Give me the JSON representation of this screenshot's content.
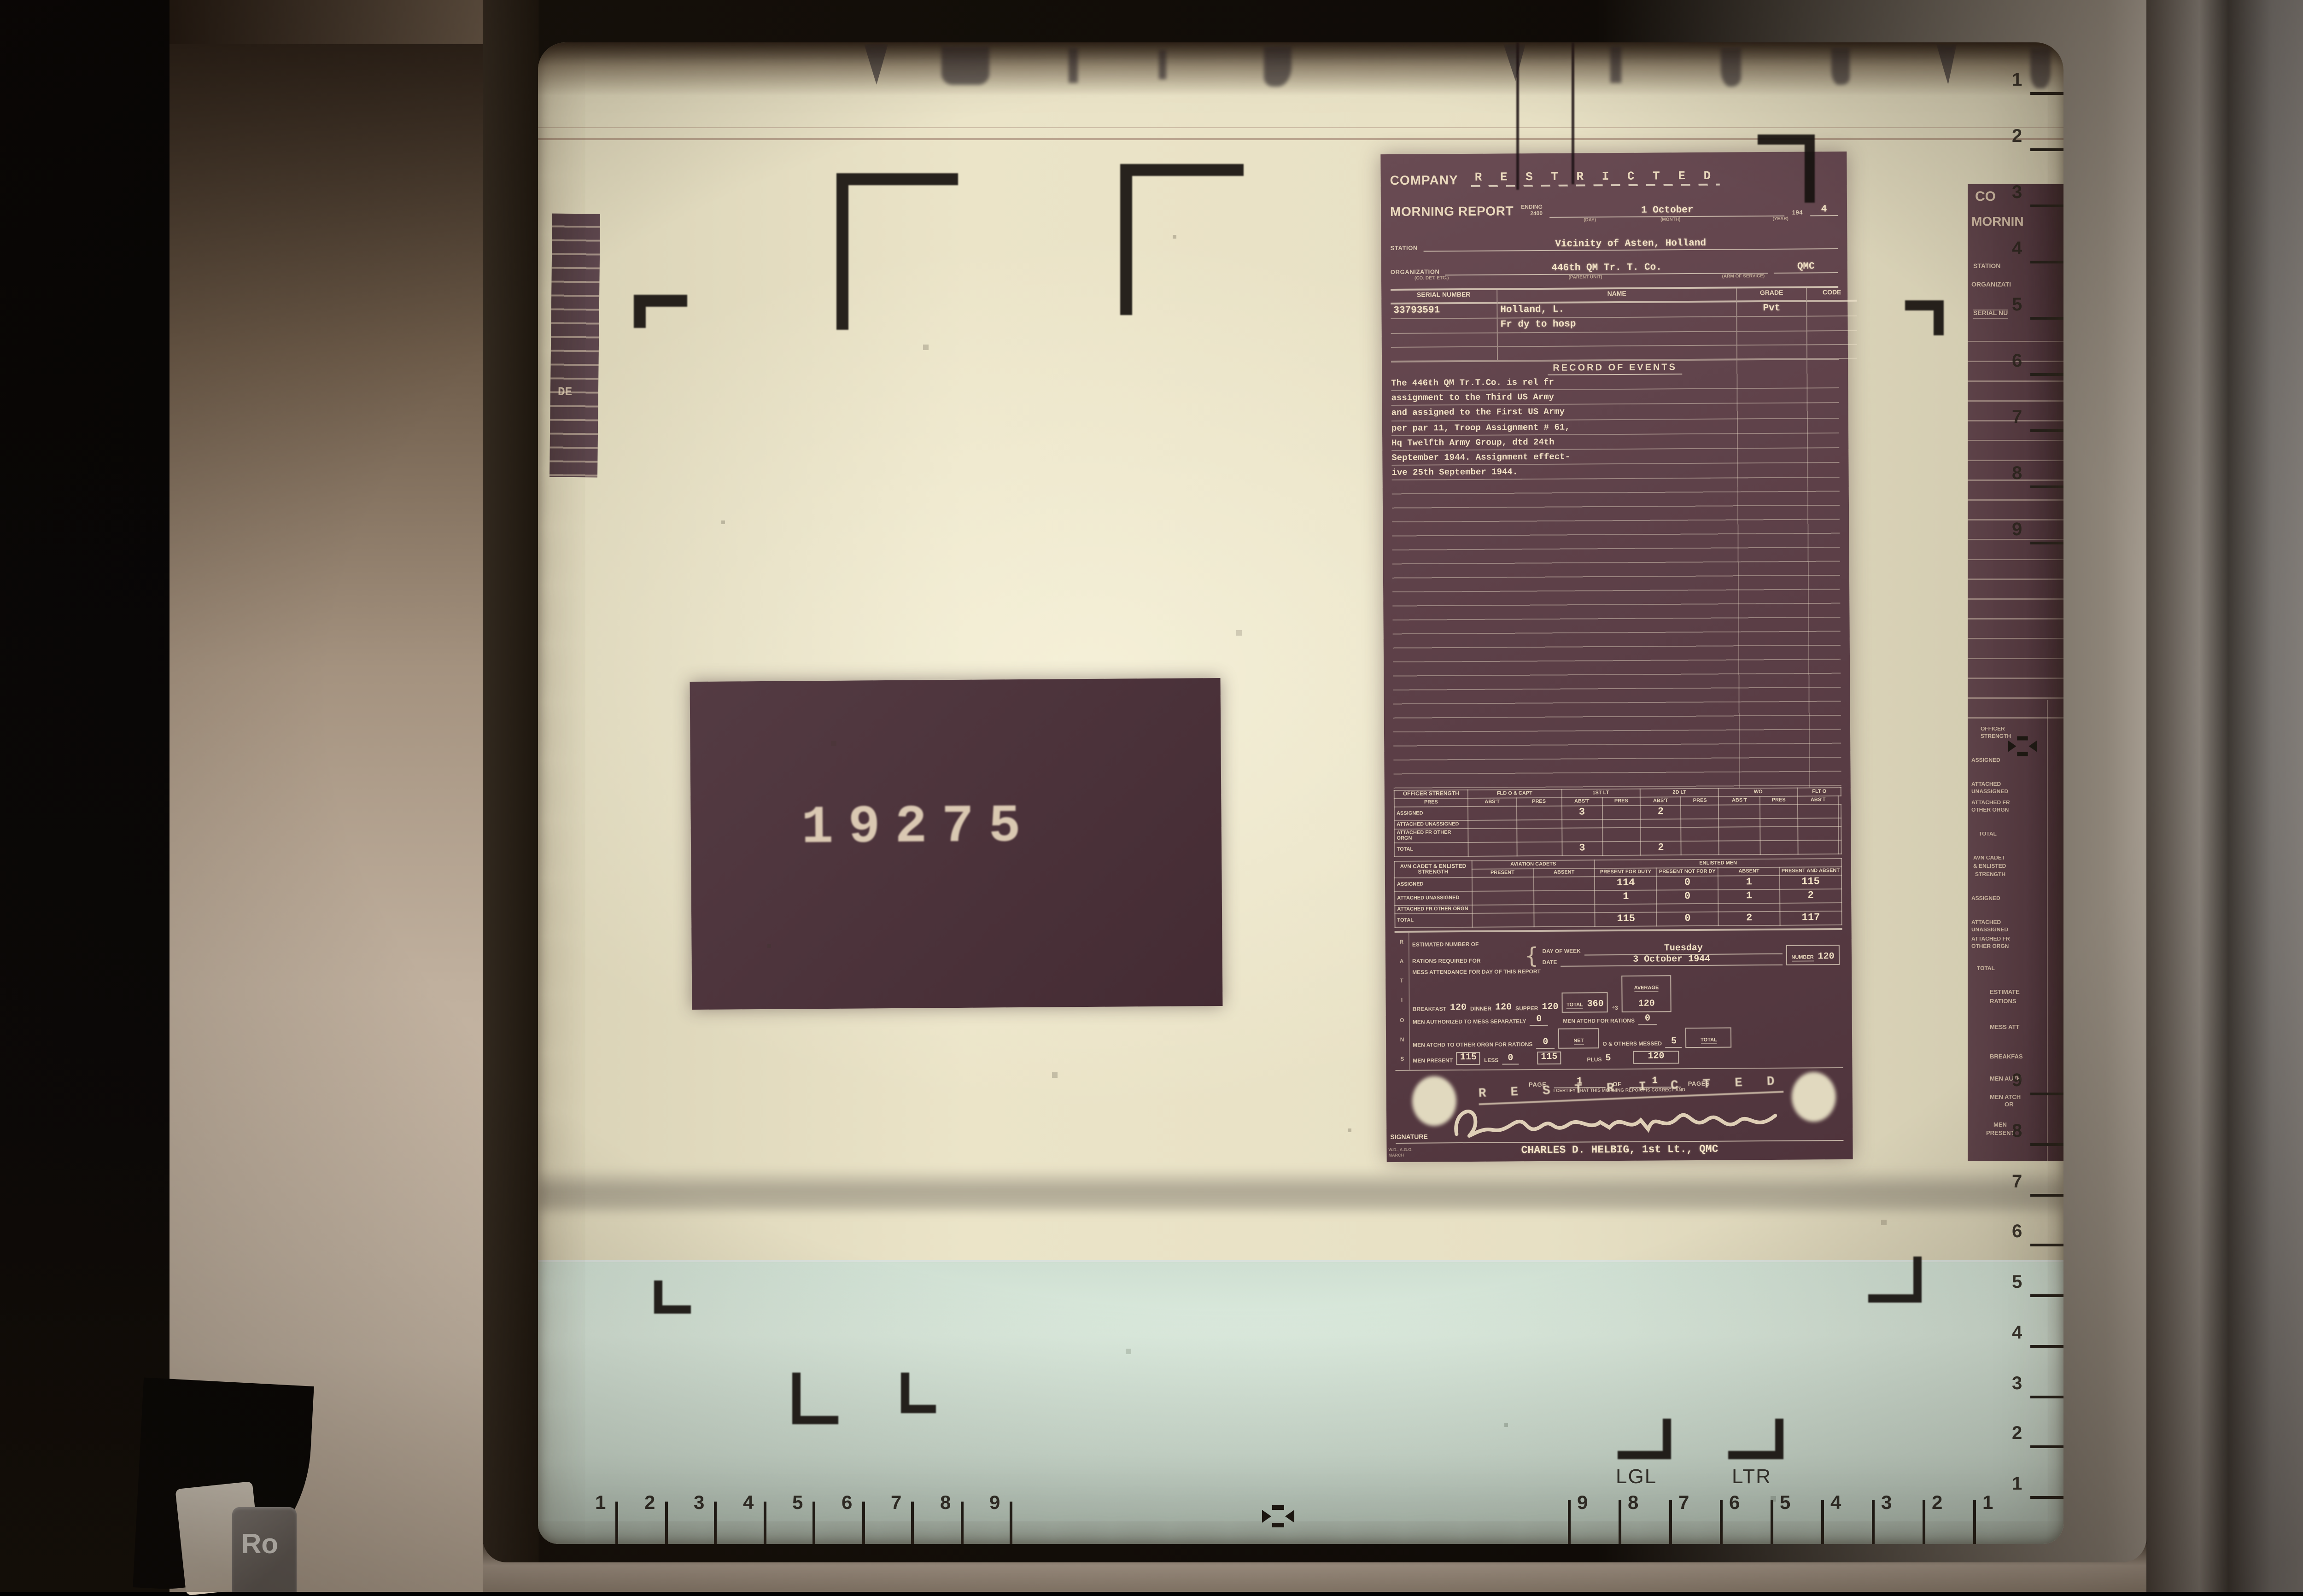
{
  "machine": {
    "key_label": "Ro"
  },
  "screen": {
    "plate_number": "19275",
    "left_strip_fragment": "DE",
    "rulers": {
      "bottom_left": [
        "1",
        "2",
        "3",
        "4",
        "5",
        "6",
        "7",
        "8",
        "9"
      ],
      "bottom_right": [
        "9",
        "8",
        "7",
        "6",
        "5",
        "4",
        "3",
        "2",
        "1"
      ],
      "right_top": [
        "1",
        "2",
        "3",
        "4",
        "5",
        "6",
        "7",
        "8",
        "9"
      ],
      "right_bottom": [
        "9",
        "8",
        "7",
        "6",
        "5",
        "4",
        "3",
        "2",
        "1"
      ],
      "size_legal": "LGL",
      "size_letter": "LTR"
    }
  },
  "document": {
    "title_company": "COMPANY",
    "title_morning": "MORNING REPORT",
    "classification": "R E S T R I C T E D",
    "ending_label": "ENDING",
    "ending_value": "2400",
    "date_value": "1 October",
    "year_prefix": "194",
    "year_value": "4",
    "sub_day": "(DAY)",
    "sub_month": "(MONTH)",
    "sub_year": "(YEAR)",
    "station_label": "STATION",
    "station_value": "Vicinity of Asten, Holland",
    "organization_label": "ORGANIZATION",
    "organization_value": "446th QM Tr. T. Co.",
    "arm_value": "QMC",
    "sub_co": "(CO. DET. ETC.)",
    "sub_parent": "(PARENT UNIT)",
    "sub_arm": "(ARM OF SERVICE)",
    "roster": {
      "headers": [
        "SERIAL NUMBER",
        "NAME",
        "GRADE",
        "CODE"
      ],
      "rows": [
        {
          "serial": "33793591",
          "name": "Holland, L.",
          "grade": "Pvt",
          "code": ""
        },
        {
          "serial": "",
          "name": "Fr dy to hosp",
          "grade": "",
          "code": ""
        }
      ]
    },
    "record_of_events": {
      "title": "RECORD OF EVENTS",
      "lines": [
        "The 446th QM Tr.T.Co. is rel fr",
        "assignment to the Third US Army",
        "and assigned to the First US Army",
        "per par 11, Troop Assignment # 61,",
        "Hq Twelfth Army Group, dtd 24th",
        "September 1944.  Assignment effect-",
        "ive 25th September 1944."
      ]
    },
    "officer_table": {
      "title": "OFFICER STRENGTH",
      "groups": [
        "FLD O & CAPT",
        "1ST LT",
        "2D LT",
        "WO",
        "FLT O"
      ],
      "sub_row": [
        "PRES",
        "ABS'T",
        "PRES",
        "ABS'T",
        "PRES",
        "ABS'T",
        "PRES",
        "ABS'T",
        "PRES",
        "ABS'T"
      ],
      "rows": [
        {
          "label": "ASSIGNED",
          "cells": [
            "",
            "",
            "3",
            "",
            "2",
            "",
            "",
            "",
            "",
            ""
          ]
        },
        {
          "label": "ATTACHED UNASSIGNED",
          "cells": [
            "",
            "",
            "",
            "",
            "",
            "",
            "",
            "",
            "",
            ""
          ]
        },
        {
          "label": "ATTACHED FR OTHER ORGN",
          "cells": [
            "",
            "",
            "",
            "",
            "",
            "",
            "",
            "",
            "",
            ""
          ]
        },
        {
          "label": "TOTAL",
          "cells": [
            "",
            "",
            "3",
            "",
            "2",
            "",
            "",
            "",
            "",
            ""
          ]
        }
      ]
    },
    "enlisted_table": {
      "title": "AVN CADET & ENLISTED STRENGTH",
      "group1": "AVIATION CADETS",
      "group2": "ENLISTED MEN",
      "sub_row": [
        "PRESENT",
        "ABSENT",
        "PRESENT FOR DUTY",
        "PRESENT NOT FOR DY",
        "ABSENT",
        "PRESENT AND ABSENT"
      ],
      "rows": [
        {
          "label": "ASSIGNED",
          "cells": [
            "",
            "",
            "114",
            "0",
            "1",
            "115"
          ]
        },
        {
          "label": "ATTACHED UNASSIGNED",
          "cells": [
            "",
            "",
            "1",
            "0",
            "1",
            "2"
          ]
        },
        {
          "label": "ATTACHED FR OTHER ORGN",
          "cells": [
            "",
            "",
            "",
            "",
            "",
            ""
          ]
        },
        {
          "label": "TOTAL",
          "cells": [
            "",
            "",
            "115",
            "0",
            "2",
            "117"
          ]
        }
      ]
    },
    "rations": {
      "rail_letters": [
        "R",
        "A",
        "T",
        "I",
        "O",
        "N",
        "S"
      ],
      "est_label1": "ESTIMATED NUMBER OF",
      "est_label2": "RATIONS REQUIRED FOR",
      "day_of_week_label": "DAY OF WEEK",
      "day_of_week": "Tuesday",
      "date_label": "DATE",
      "date": "3 October 1944",
      "number_label": "NUMBER",
      "number": "120",
      "mess_label": "MESS ATTENDANCE FOR DAY OF THIS REPORT",
      "breakfast_label": "BREAKFAST",
      "breakfast": "120",
      "dinner_label": "DINNER",
      "dinner": "120",
      "supper_label": "SUPPER",
      "supper": "120",
      "total_label": "TOTAL",
      "total": "360",
      "divisor": "÷3",
      "average_label": "AVERAGE",
      "average": "120",
      "mess_sep_label": "MEN AUTHORIZED TO MESS SEPARATELY",
      "mess_sep": "0",
      "atchd_rations_label": "MEN ATCHD FOR RATIONS",
      "atchd_rations": "0",
      "atchd_other_label": "MEN ATCHD TO OTHER ORGN FOR RATIONS",
      "atchd_other": "0",
      "net_label": "NET",
      "others_messed_label": "O & OTHERS MESSED",
      "others_messed": "5",
      "men_present_label": "MEN PRESENT",
      "men_present": "115",
      "less_label": "LESS",
      "less": "0",
      "net": "115",
      "plus_label": "PLUS",
      "plus": "5",
      "grand_total_label": "TOTAL",
      "grand_total": "120"
    },
    "footer": {
      "page_label": "PAGE",
      "page": "1",
      "of_label": "OF",
      "pages": "1",
      "pages_label": "PAGES",
      "certify_line": "I CERTIFY THAT THIS MORNING REPORT IS CORRECT AND",
      "stamp": "R E S T R I C T E D",
      "signature_label": "SIGNATURE",
      "signature_name": "CHARLES D. HELBIG, 1st Lt., QMC",
      "form_note1": "W.D., A.G.O.",
      "form_note2": "MARCH"
    }
  },
  "right_doc": {
    "line1": "CO",
    "line2": "MORNIN",
    "station": "STATION",
    "organization": "ORGANIZATI",
    "serial": "SERIAL NU",
    "officer1": "OFFICER",
    "officer2": "STRENGTH",
    "assigned1": "ASSIGNED",
    "att1a": "ATTACHED",
    "att1b": "UNASSIGNED",
    "att1c": "ATTACHED FR",
    "att1d": "OTHER ORGN",
    "total1": "TOTAL",
    "avn1": "AVN CADET",
    "avn2": "& ENLISTED",
    "avn3": "STRENGTH",
    "assigned2": "ASSIGNED",
    "att2a": "ATTACHED",
    "att2b": "UNASSIGNED",
    "att2c": "ATTACHED FR",
    "att2d": "OTHER ORGN",
    "total2": "TOTAL",
    "r1": "ESTIMATE",
    "r2": "RATIONS",
    "r3": "MESS ATT",
    "r4": "BREAKFAS",
    "r5": "MEN AUTH",
    "r6": "MEN ATCH",
    "r7": "OR",
    "r8": "MEN",
    "r9": "PRESENT"
  }
}
